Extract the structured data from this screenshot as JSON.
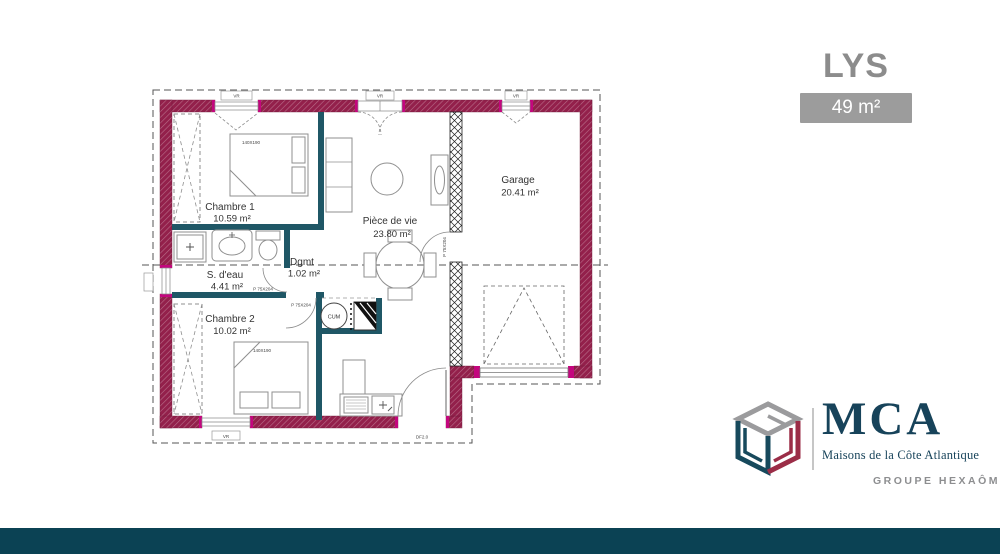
{
  "header": {
    "plan_name": "LYS",
    "area_label": "49 m²"
  },
  "floorplan": {
    "rooms": [
      {
        "name": "Chambre 1",
        "area": "10.59 m²"
      },
      {
        "name": "S. d'eau",
        "area": "4.41 m²"
      },
      {
        "name": "Chambre 2",
        "area": "10.02 m²"
      },
      {
        "name": "Dgmt",
        "area": "1.02 m²"
      },
      {
        "name": "Pièce de vie",
        "area": "23.80 m²"
      },
      {
        "name": "Garage",
        "area": "20.41 m²"
      }
    ],
    "annotations": {
      "window_shutter": "VR",
      "interior_door": "P 75X204",
      "bed_size": "140X190",
      "water_heater": "CUM",
      "entry_door": "DF2.0"
    },
    "colors": {
      "exterior_wall": "#93204b",
      "window_accent": "#c4067e",
      "interior_wall": "#1f5766",
      "furniture_line": "#8f8f8f",
      "label_text": "#333333"
    }
  },
  "branding": {
    "company": "MCA",
    "tagline": "Maisons de la Côte Atlantique",
    "group": "GROUPE HEXAÔM",
    "colors": {
      "navy": "#17435a",
      "gray": "#9b9b9d",
      "crimson": "#9b2d47",
      "teal": "#17495c"
    }
  },
  "footer": {
    "bar_color": "#0b4254"
  }
}
